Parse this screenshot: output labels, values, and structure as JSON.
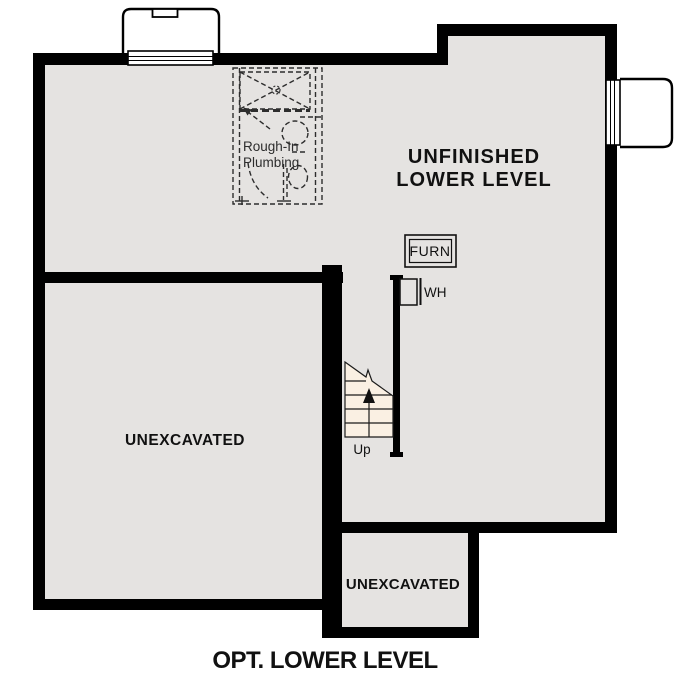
{
  "plan": {
    "title": "OPT. LOWER LEVEL",
    "rooms": {
      "main": {
        "line1": "UNFINISHED",
        "line2": "LOWER LEVEL"
      },
      "left": {
        "label": "UNEXCAVATED"
      },
      "bottom": {
        "label": "UNEXCAVATED"
      }
    },
    "labels": {
      "furnace": "FURN",
      "water_heater": "WH",
      "stairs_up": "Up",
      "plumbing_line1": "Rough-In",
      "plumbing_line2": "Plumbing"
    },
    "colors": {
      "wall": "#000000",
      "floor": "#e5e3e1",
      "stair": "#faf0e3",
      "well": "#ffffff",
      "ink": "#111111",
      "plumbing": "#2d2d2d"
    }
  }
}
